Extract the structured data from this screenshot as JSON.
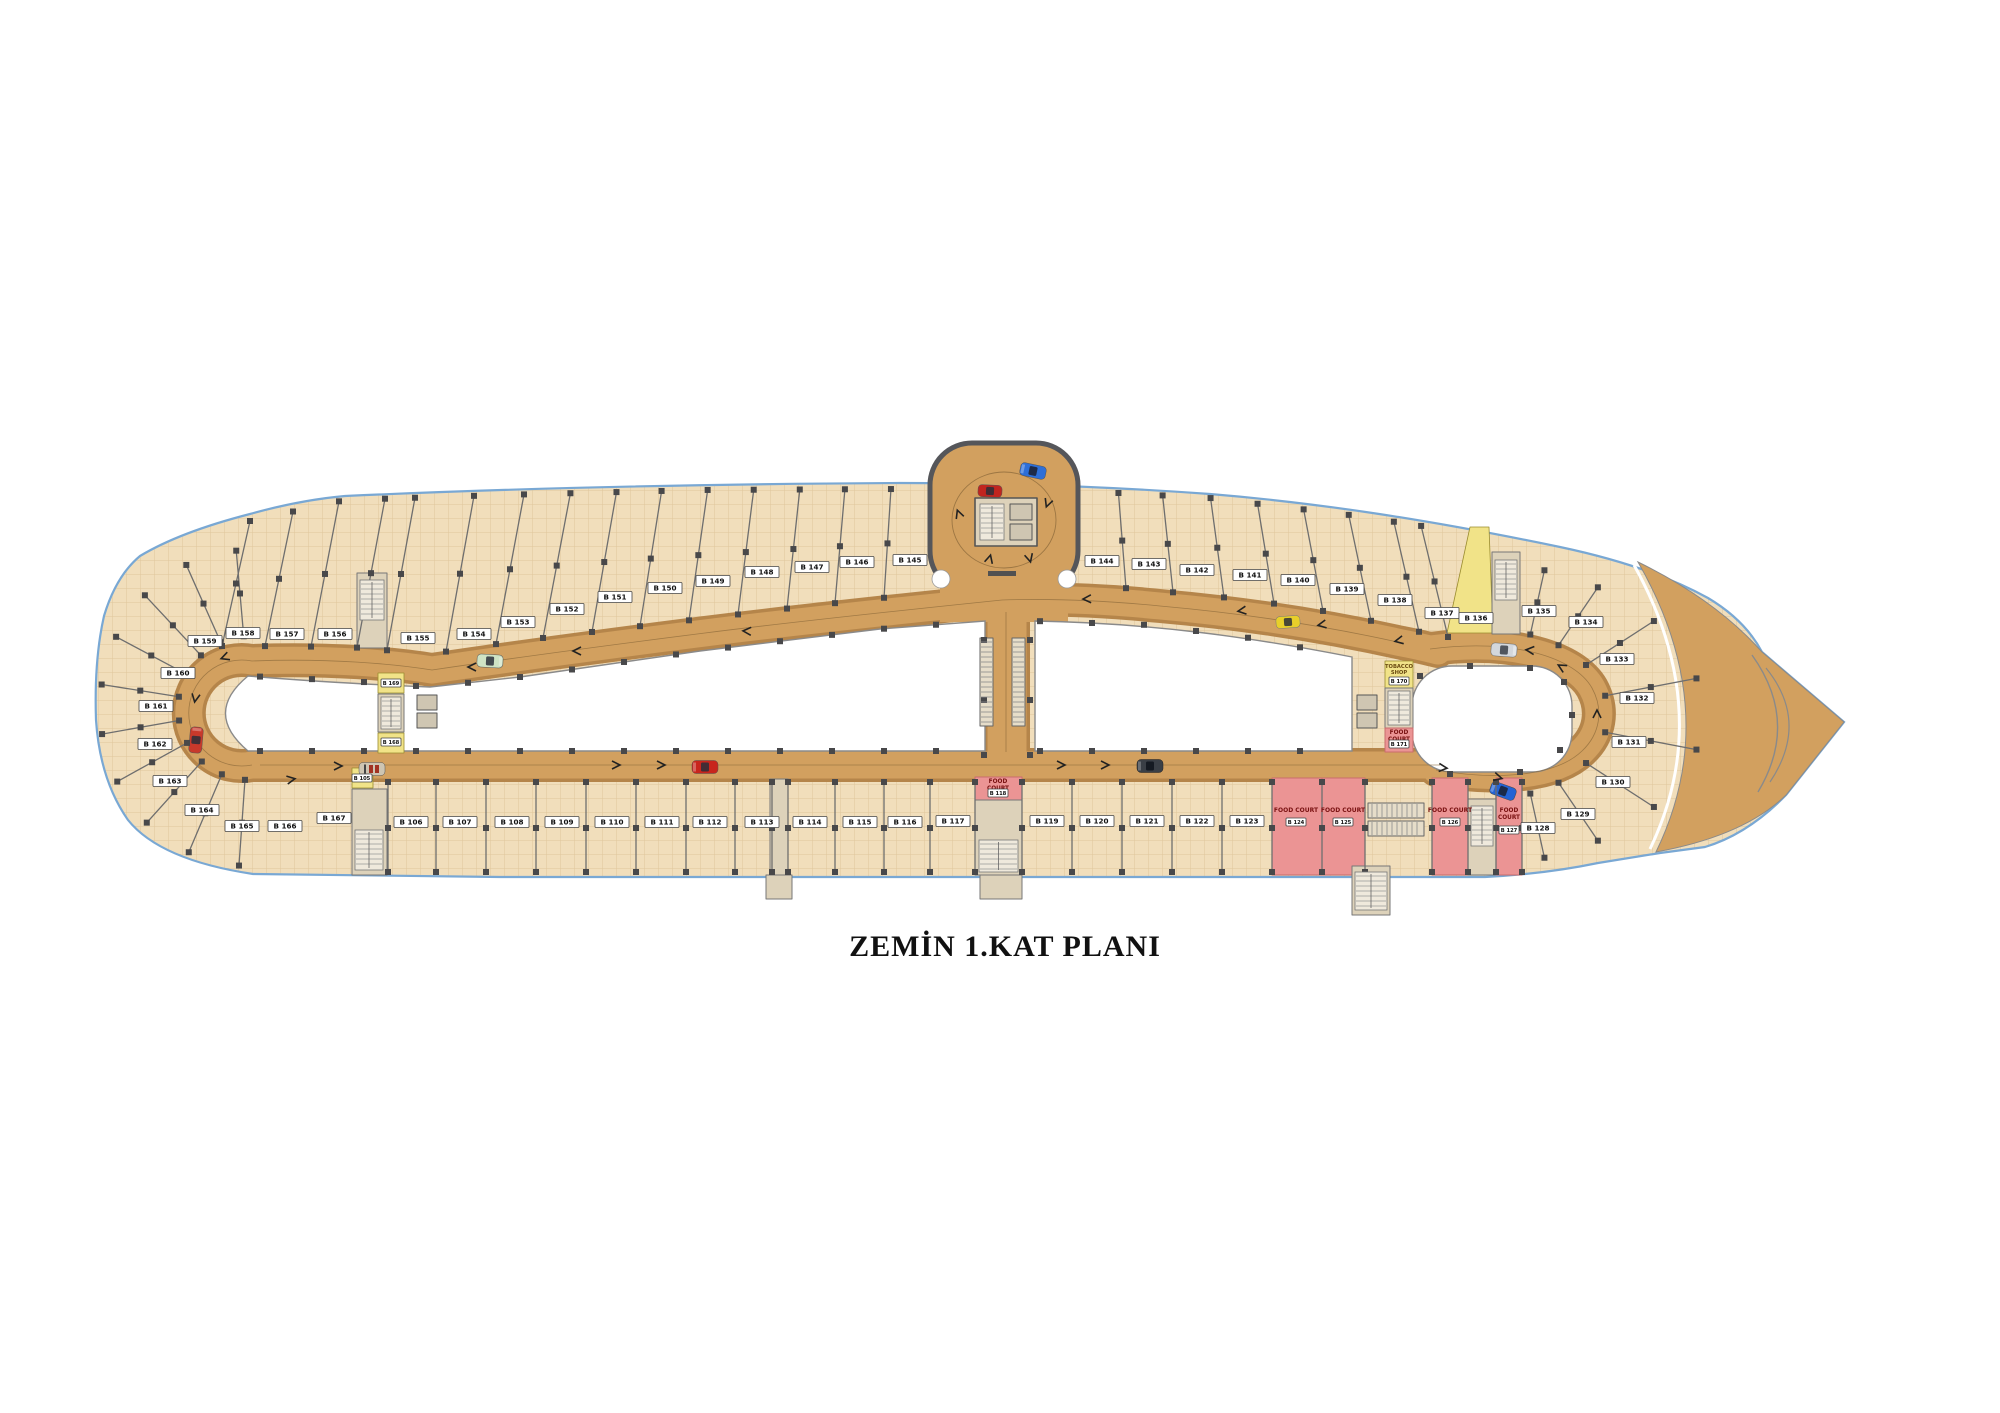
{
  "title": "ZEMİN 1.KAT PLANI",
  "legend": {
    "food_court": "FOOD COURT",
    "tobacco_shop_line1": "TOBACCO",
    "tobacco_shop_line2": "SHOP",
    "food_line1": "FOOD",
    "food_line2": "COURT"
  },
  "units": {
    "top_row": [
      "B 158",
      "B 157",
      "B 156",
      "B 155",
      "B 154",
      "B 153",
      "B 152",
      "B 151",
      "B 150",
      "B 149",
      "B 148",
      "B 147",
      "B 146",
      "B 145",
      "B 144",
      "B 143",
      "B 142",
      "B 141",
      "B 140",
      "B 139",
      "B 138",
      "B 137",
      "B 136",
      "B 135"
    ],
    "left_fan": [
      "B 159",
      "B 160",
      "B 161",
      "B 162",
      "B 163",
      "B 164",
      "B 165",
      "B 166",
      "B 167"
    ],
    "right_fan": [
      "B 134",
      "B 133",
      "B 132",
      "B 131",
      "B 130",
      "B 129",
      "B 128"
    ],
    "bottom_row": [
      "B 106",
      "B 107",
      "B 108",
      "B 109",
      "B 110",
      "B 111",
      "B 112",
      "B 113",
      "B 114",
      "B 115",
      "B 116",
      "B 117",
      "B 119",
      "B 120",
      "B 121",
      "B 122",
      "B 123"
    ],
    "food_courts": [
      "B 118",
      "B 124",
      "B 125",
      "B 126",
      "B 127",
      "B 171"
    ],
    "kiosks": [
      "B 105",
      "B 168",
      "B 169"
    ],
    "tobacco_shop": "B 170"
  },
  "colors": {
    "shop_floor": "#f1debb",
    "shop_grid": "#e0c69b",
    "road": "#d2a05f",
    "road_edge": "#b5854a",
    "food_court": "#eb9494",
    "food_court_border": "#c96c6c",
    "food_court_text": "#7a1212",
    "kiosk": "#f1e388",
    "core": "#ddd2ba",
    "island": "#ffffff",
    "boundary_blue": "#79a8d4",
    "bulge_border": "#55565a",
    "column": "#48484a"
  },
  "cars": [
    {
      "name": "red-car-left-loop",
      "color": "#c8392b"
    },
    {
      "name": "convertible-lower-road",
      "color": "#cec5b2"
    },
    {
      "name": "green-car-upper-road",
      "color": "#cfe3c4"
    },
    {
      "name": "red-car-lower-road",
      "color": "#c8251d"
    },
    {
      "name": "red-car-entry-loop",
      "color": "#c0251f"
    },
    {
      "name": "blue-car-entry-loop",
      "color": "#2e6fd8"
    },
    {
      "name": "black-car-lower-road",
      "color": "#3a3f46"
    },
    {
      "name": "taxi-upper-road",
      "color": "#e8cf2a"
    },
    {
      "name": "silver-car-right-loop",
      "color": "#d3d7dc"
    },
    {
      "name": "blue-car-right-loop",
      "color": "#2563d4"
    }
  ]
}
